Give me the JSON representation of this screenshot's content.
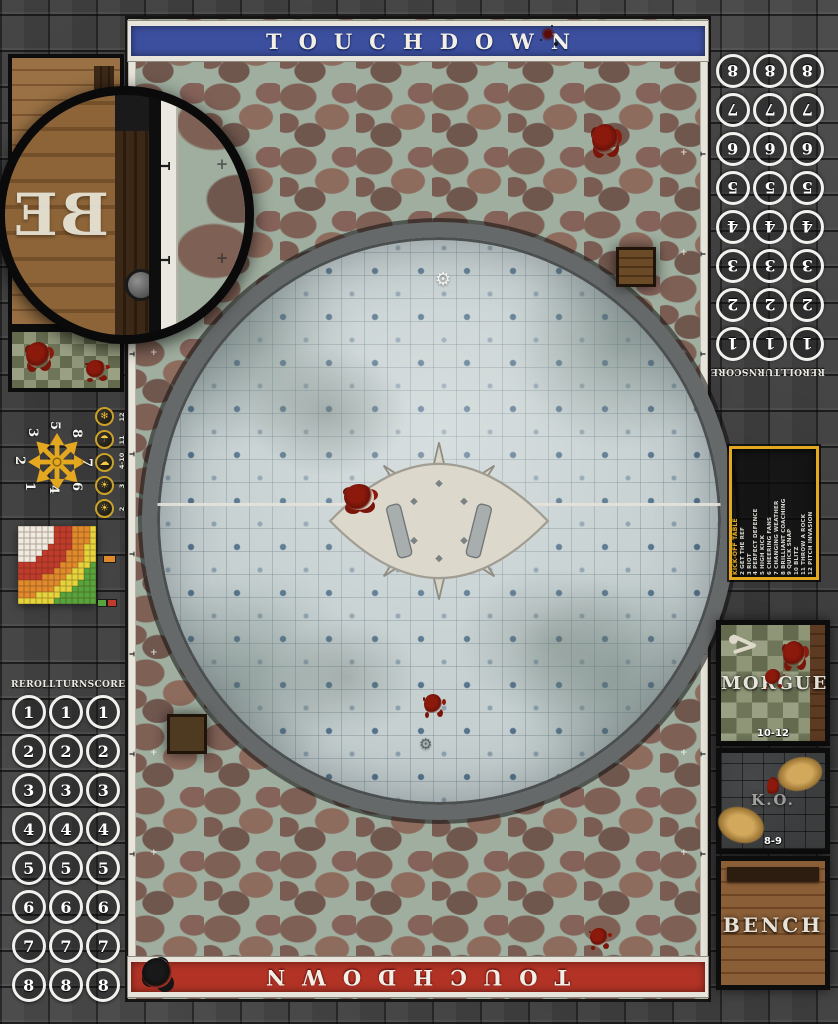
{
  "banners": {
    "top_label": "TOUCHDOWN",
    "bottom_label": "TOUCHDOWN"
  },
  "score_track": {
    "headers": [
      "REROLL",
      "TURN",
      "SCORE"
    ],
    "rows": [
      "1",
      "2",
      "3",
      "4",
      "5",
      "6",
      "7",
      "8"
    ],
    "columns_per_row": 3
  },
  "weather_table": {
    "entries": [
      {
        "range": "12",
        "icon": "blizzard-icon",
        "glyph": "❄"
      },
      {
        "range": "11",
        "icon": "pouring-rain-icon",
        "glyph": "☂"
      },
      {
        "range": "4-10",
        "icon": "perfect-conditions-icon",
        "glyph": "☁"
      },
      {
        "range": "3",
        "icon": "very-sunny-icon",
        "glyph": "☀"
      },
      {
        "range": "2",
        "icon": "sweltering-heat-icon",
        "glyph": "☀"
      }
    ]
  },
  "scatter_template": {
    "numbers": [
      "1",
      "2",
      "3",
      "4",
      "5",
      "6",
      "7",
      "8"
    ]
  },
  "range_ruler": {
    "grid_size": 13,
    "bands": [
      {
        "name": "quick-pass",
        "color": "#EFEBE0"
      },
      {
        "name": "short-pass",
        "color": "#C13B2C"
      },
      {
        "name": "long-pass",
        "color": "#E08A2C"
      },
      {
        "name": "long-bomb",
        "color": "#E6D43C"
      },
      {
        "name": "extreme-range",
        "color": "#57A43C"
      }
    ]
  },
  "kickoff_table": {
    "title": "KICK-OFF TABLE",
    "entries": [
      "2 GET THE REF",
      "3 RIOT",
      "4 PERFECT DEFENCE",
      "5 HIGH KICK",
      "6 CHEERING FANS",
      "7 CHANGING WEATHER",
      "8 BRILLIANT COACHING",
      "9 QUICK SNAP",
      "10 BLITZ",
      "11 THROW A ROCK",
      "12 PITCH INVASION"
    ]
  },
  "dugout": {
    "morgue_label": "MORGUE",
    "morgue_range": "10-12",
    "ko_label": "K.O.",
    "ko_range": "8-9",
    "bench_label": "BENCH"
  },
  "inset": {
    "visible_letters": "BE"
  },
  "pitch_marks": {
    "cross": "+",
    "tick": "T",
    "gear": "⚙"
  },
  "colors": {
    "banner_blue": "#3C4F9F",
    "banner_red": "#B23326",
    "accent_gold": "#E3A81F",
    "arena_tile": "#C6D0D1",
    "cobblestone": "#8A6F63",
    "frame_stone": "#454545"
  }
}
